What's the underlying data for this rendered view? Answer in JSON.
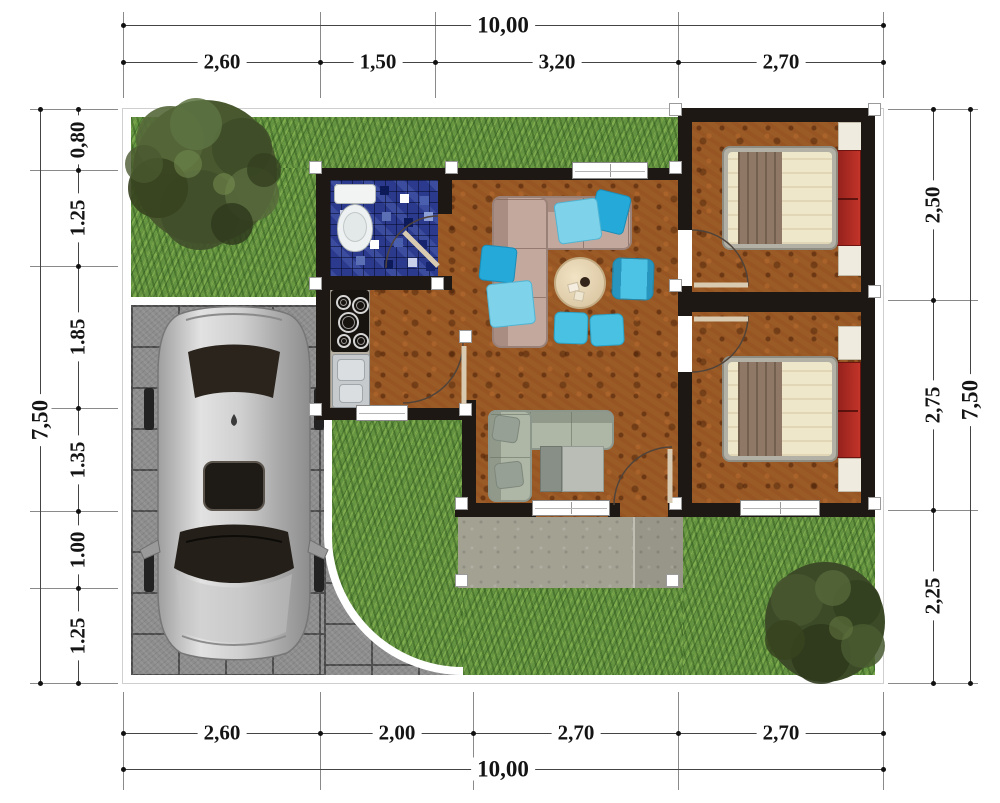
{
  "title": "house-site-floor-plan",
  "dims": {
    "top": {
      "total": "10,00",
      "segments": [
        "2,60",
        "1,50",
        "3,20",
        "2,70"
      ]
    },
    "bottom": {
      "total": "10,00",
      "segments": [
        "2,60",
        "2,00",
        "2,70",
        "2,70"
      ]
    },
    "left": {
      "total": "7,50",
      "segments": [
        "0,80",
        "1.25",
        "1.85",
        "1.35",
        "1.00",
        "1.25"
      ]
    },
    "right": {
      "total": "7,50",
      "segments": [
        "2,50",
        "2,75",
        "2,25"
      ]
    }
  },
  "colors": {
    "wall": "#1d1813",
    "curb": "#ffffff",
    "grass": "#639340",
    "paver": "#8d8d8d",
    "floor": "#9b5b27",
    "tile_blue": "#2b3a8c",
    "terrace": "#a3a192",
    "sofa_beige": "#c3a89e",
    "pillow_cyan": "#3fbde2",
    "sofa_sage": "#aeb6a6",
    "bed_cream": "#efe7ca",
    "bed_red": "#b02a22",
    "blanket_brown": "#8f7966",
    "car_silver": "#c9c9c9",
    "tree_green": "#49582f",
    "dim_line": "#444444",
    "dim_text": "#141414"
  }
}
